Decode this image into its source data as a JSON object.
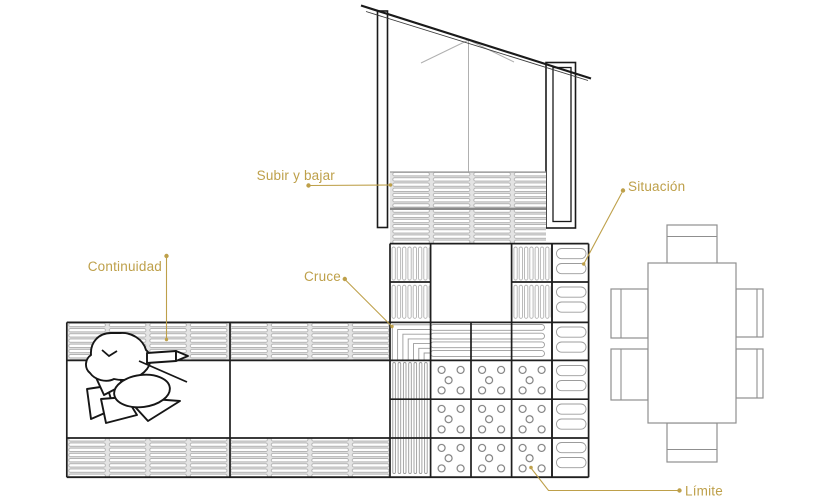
{
  "labels": {
    "subir": "Subir y bajar",
    "situacion": "Situación",
    "continuidad": "Continuidad",
    "cruce": "Cruce",
    "limite": "Límite"
  },
  "palette": {
    "accent": "#BEA04A",
    "line": "#1f1f1f",
    "drawing_gray": "#9c9c9c",
    "slat_background": "#e3e3e3"
  }
}
